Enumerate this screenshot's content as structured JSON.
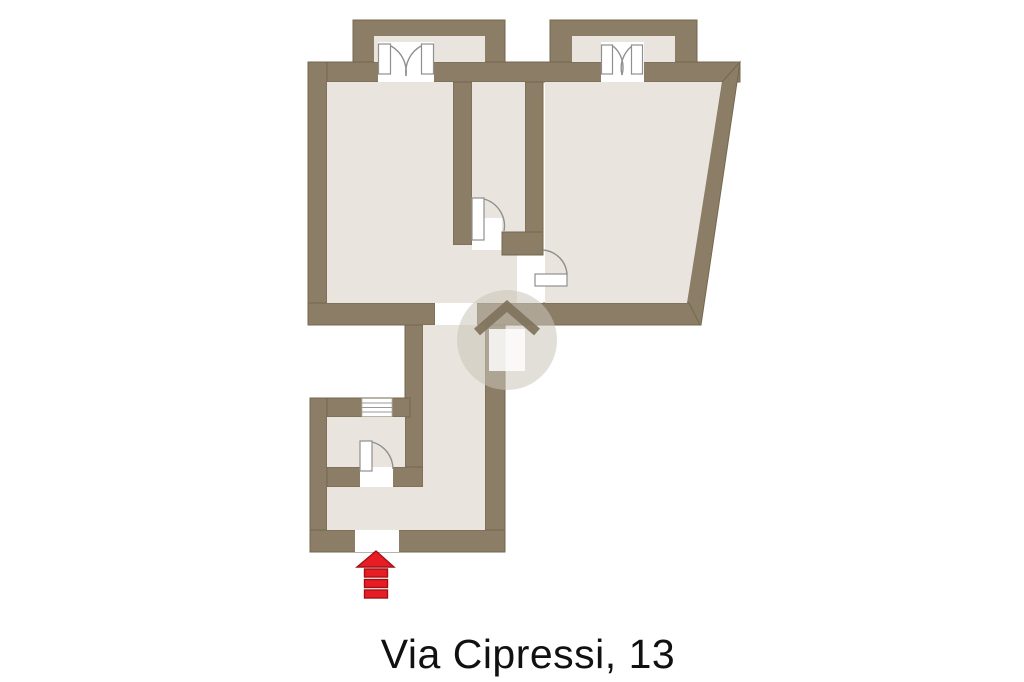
{
  "caption": {
    "text": "Via Cipressi, 13"
  },
  "colors": {
    "background": "#ffffff",
    "wall": "#8b7d66",
    "wall_edge": "#74684f",
    "floor": "#e9e5de",
    "opening": "#ffffff",
    "door": "#8f8f8f",
    "stair_line": "#9a9a9a",
    "arrow_fill": "#e81c24",
    "arrow_edge": "#a31117",
    "watermark_tint": "rgba(202,196,184,0.55)",
    "watermark_house": "rgba(130,117,95,0.95)",
    "caption_text": "#111111"
  },
  "plan": {
    "kind": "residential-floor-plan",
    "address_label": "Via Cipressi, 13",
    "balconies": 2,
    "french_double_doors": 2,
    "interior_doors": 3,
    "has_staircase": true,
    "entrance_marker": "red-arrow-up",
    "watermark": "house-logo-circle"
  }
}
